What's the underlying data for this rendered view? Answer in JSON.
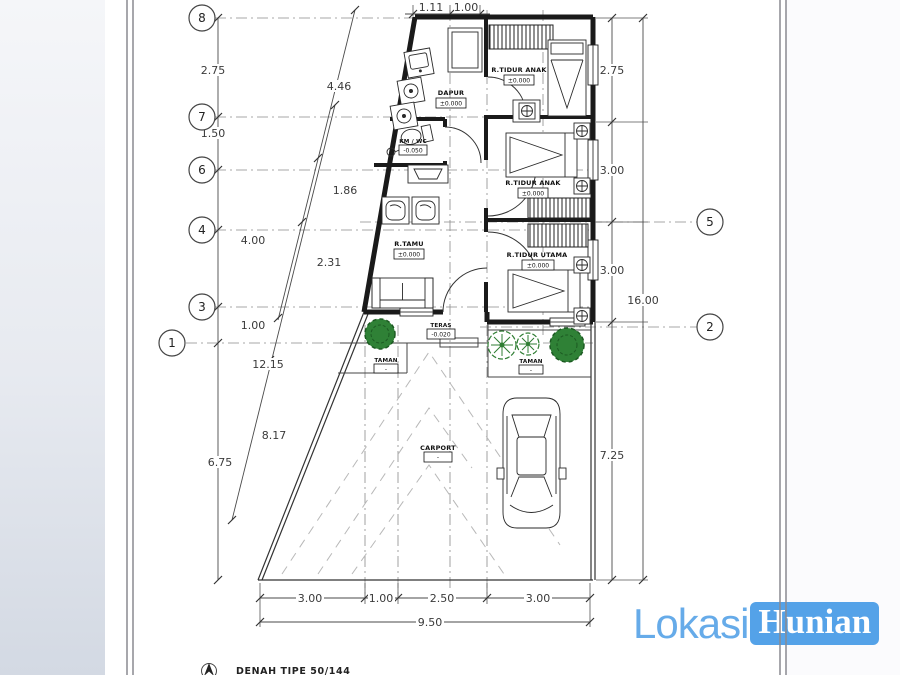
{
  "watermark": {
    "text_light": "Lokasi",
    "text_badge": "Hunian"
  },
  "colors": {
    "watermark_text": "#66abe9",
    "watermark_badge": "#54a2e8",
    "tree_green": "#2f8136",
    "line_dark": "#1a1a1a"
  },
  "title_block": {
    "label": "DENAH TIPE 50/144"
  },
  "grid": {
    "left": [
      "8",
      "7",
      "6",
      "4",
      "3",
      "1"
    ],
    "right": [
      "5",
      "2"
    ]
  },
  "dims": {
    "top": [
      "1.11",
      "1.00"
    ],
    "left": [
      "2.75",
      "1.50",
      "4.00",
      "1.00",
      "6.75"
    ],
    "slant": [
      "4.46",
      "1.86",
      "2.31",
      "12.15",
      "8.17"
    ],
    "right": [
      "2.75",
      "3.00",
      "3.00",
      "7.25"
    ],
    "right_total": "16.00",
    "bottom": [
      "3.00",
      "1.00",
      "2.50",
      "3.00"
    ],
    "bottom_total": "9.50"
  },
  "rooms": {
    "dapur": {
      "name": "DAPUR",
      "elev": "±0.000"
    },
    "tidur_anak_1": {
      "name": "R.TIDUR ANAK",
      "elev": "±0.000"
    },
    "km_wc": {
      "name": "KM / WC",
      "elev": "-0.050"
    },
    "tamu": {
      "name": "R.TAMU",
      "elev": "±0.000"
    },
    "tidur_anak_2": {
      "name": "R.TIDUR ANAK",
      "elev": "±0.000"
    },
    "tidur_utama": {
      "name": "R.TIDUR UTAMA",
      "elev": "±0.000"
    },
    "teras": {
      "name": "TERAS",
      "elev": "-0.020"
    },
    "taman_left": {
      "name": "TAMAN",
      "elev": "-"
    },
    "taman_right": {
      "name": "TAMAN",
      "elev": "-"
    },
    "carport": {
      "name": "CARPORT",
      "elev": "-"
    }
  }
}
